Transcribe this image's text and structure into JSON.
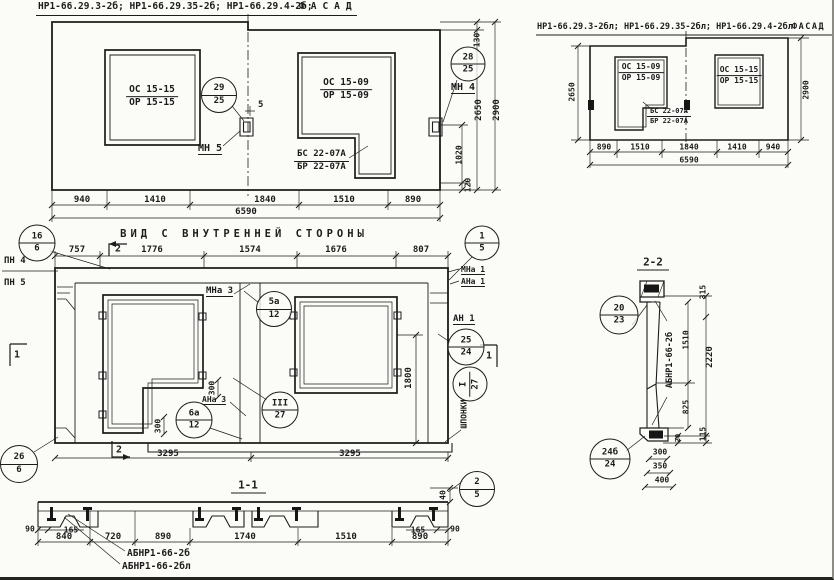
{
  "facade_left": {
    "title": "НР1-66.29.3-2б; НР1-66.29.35-2б; НР1-66.29.4-2б;",
    "facade_word": "ФАСАД",
    "window_left": {
      "top": "ОС 15-15",
      "bottom": "ОР 15-15"
    },
    "window_right": {
      "top": "ОС 15-09",
      "bottom": "ОР 15-09"
    },
    "window_right_extra": {
      "top": "БС 22-07А",
      "bottom": "БР 22-07А"
    },
    "callout_left": {
      "top": "29",
      "bottom": "25"
    },
    "callout_right": {
      "top": "28",
      "bottom": "25"
    },
    "mark_mn5": "МН 5",
    "mark_mn4": "МН 4",
    "level_mark": "5",
    "dims_bottom": [
      "940",
      "1410",
      "1840",
      "1510",
      "890"
    ],
    "dim_total": "6590",
    "dim_step": "130",
    "dim_height_inner": "2650",
    "dim_height": "2900",
    "dim_latch": "1020",
    "dim_bottom_edge": "120"
  },
  "facade_right": {
    "title": "НР1-66.29.3-2бл; НР1-66.29.35-2бл; НР1-66.29.4-2бл",
    "facade_word": "ФАСАД",
    "window_left": {
      "top": "ОС 15-09",
      "bottom": "ОР 15-09"
    },
    "window_left_extra": {
      "top": "БС 22-07А",
      "bottom": "БР 22-07А"
    },
    "window_right": {
      "top": "ОС 15-15",
      "bottom": "ОР 15-15"
    },
    "dims_bottom": [
      "890",
      "1510",
      "1840",
      "1410",
      "940"
    ],
    "dim_total": "6590",
    "dim_height_inner": "2650",
    "dim_height": "2900"
  },
  "inner_view": {
    "title": "ВИД С ВНУТРЕННЕЙ СТОРОНЫ",
    "dims_top": [
      "757",
      "1776",
      "1574",
      "1676",
      "807"
    ],
    "marks": {
      "pn4": "ПН 4",
      "pn5": "ПН 5",
      "mna3": "МНа 3",
      "mna1": "МНа 1",
      "ana1": "АНа 1",
      "an1": "АН 1",
      "ana3": "АНа 3",
      "keys": "ШПОНКИ"
    },
    "callouts": {
      "c16": {
        "top": "16",
        "bottom": "6"
      },
      "c1": {
        "top": "1",
        "bottom": "5"
      },
      "c5a": {
        "top": "5а",
        "bottom": "12"
      },
      "c3": {
        "top": "III",
        "bottom": "27"
      },
      "c6a": {
        "top": "6а",
        "bottom": "12"
      },
      "c25": {
        "top": "25",
        "bottom": "24"
      },
      "cI": {
        "top": "I",
        "bottom": "27"
      },
      "c26": {
        "top": "26",
        "bottom": "6"
      }
    },
    "section_marks": {
      "top": "2",
      "bottom": "2",
      "left": "1",
      "right": "1"
    },
    "dims": {
      "d300_step": "300",
      "d300_corner": "300",
      "d1800": "1800",
      "d3295_left": "3295",
      "d3295_right": "3295"
    }
  },
  "section_1_1": {
    "title": "1-1",
    "callout": {
      "top": "2",
      "bottom": "5"
    },
    "dim_40": "40",
    "dims_bottom": [
      "840",
      "720",
      "890",
      "1740",
      "1510",
      "890"
    ],
    "dim_165_left": "165",
    "dim_165_right": "165",
    "dim_90_left": "90",
    "dim_90_right": "90",
    "label_top": "АБНР1-66-2б",
    "label_bottom": "АБНР1-66-2бл"
  },
  "section_2_2": {
    "title": "2-2",
    "panel_label": "АБНР1-66-2б",
    "callout_top": {
      "top": "20",
      "bottom": "23"
    },
    "callout_bottom": {
      "top": "24б",
      "bottom": "24"
    },
    "dims": {
      "d315": "315",
      "d1510": "1510",
      "d2220": "2220",
      "d825": "825",
      "d20": "20",
      "d115": "115",
      "d300": "300",
      "d350": "350",
      "d400": "400"
    }
  }
}
